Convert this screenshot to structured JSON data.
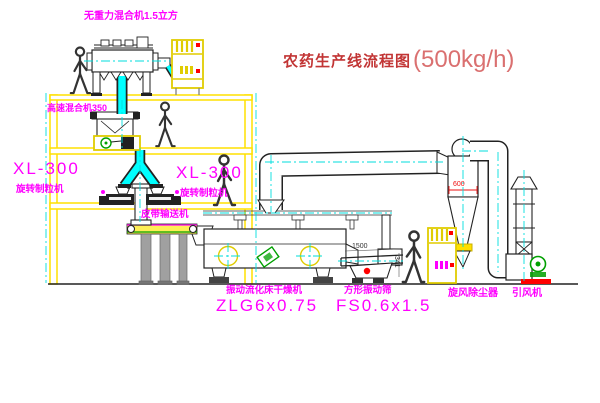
{
  "title": {
    "text": "农药生产线流程图",
    "capacity": "(500kg/h)"
  },
  "labels": {
    "gravity_mixer": "无重力混合机1.5立方",
    "high_speed_mixer": "高速混合机350",
    "granulator_left": {
      "model": "XL-300",
      "name": "旋转制粒机"
    },
    "granulator_right": {
      "model": "XL-300",
      "name": "旋转制粒机"
    },
    "belt_conveyor": "皮带输送机",
    "dryer": {
      "name": "振动流化床干燥机",
      "model": "ZLG6x0.75"
    },
    "sieve": {
      "name": "方形振动筛",
      "model": "FS0.6x1.5"
    },
    "cyclone": "旋风除尘器",
    "fan": "引风机"
  },
  "dimensions": {
    "cyclone_width": "600",
    "sieve_length": "1500",
    "sieve_height": "341"
  },
  "colors": {
    "label_magenta": "#ff00ff",
    "title_red": "#c23535",
    "capacity_red": "#da7070",
    "frame_yellow": "#ffe000",
    "pipe_cyan": "#00ffff",
    "centerline_cyan": "#00dede",
    "motor_green": "#00a000",
    "alarm_red": "#ff0000"
  }
}
